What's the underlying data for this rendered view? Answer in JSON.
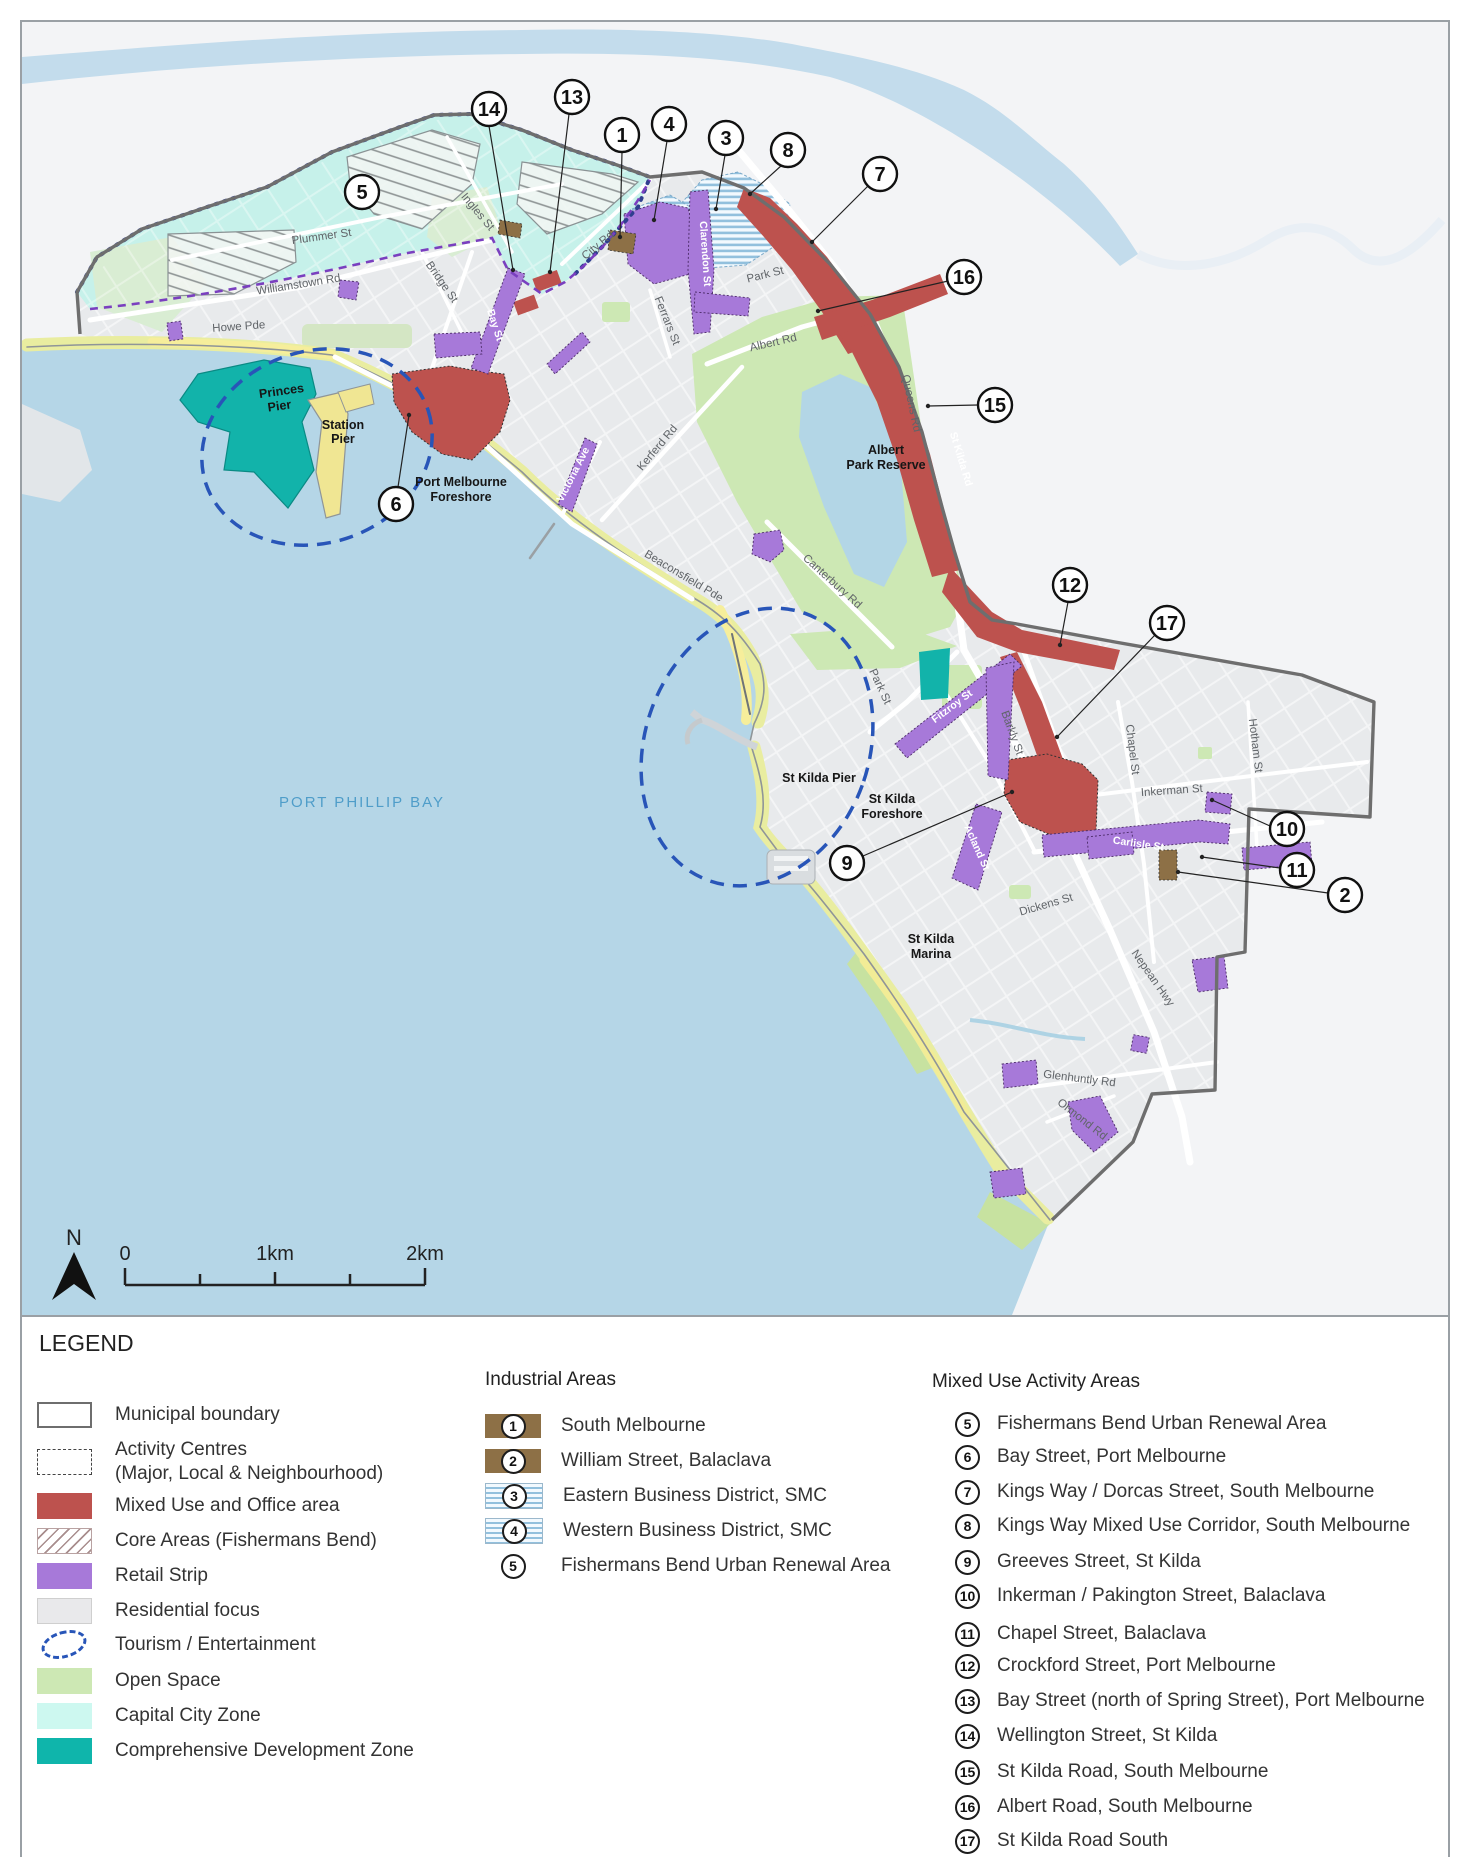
{
  "colors": {
    "water": "#b5d6e7",
    "land_outside": "#f3f4f6",
    "land_municipal": "#e8eaec",
    "open_space": "#cde8b4",
    "capital_city_zone": "#c6f1ea",
    "comprehensive_development": "#12b3aa",
    "mixed_use_office": "#bd524e",
    "retail_strip": "#a779d9",
    "industrial_brown": "#8d7046",
    "business_stripe_blue": "#92c0dd",
    "foreshore_yellow": "#e9eda0",
    "municipal_boundary": "#6e6e6e",
    "tourism_dash_blue": "#2855b8",
    "activity_dash_purple": "#7a3fbf",
    "bay_label_blue": "#4f9dc9"
  },
  "map": {
    "bay_label": "PORT PHILLIP BAY",
    "north_label": "N",
    "scale": {
      "zero": "0",
      "one": "1km",
      "two": "2km"
    },
    "labels": {
      "plummer_st": "Plummer St",
      "ingles_st": "Ingles St",
      "bridge_st": "Bridge St",
      "williamstown_rd": "Williamstown Rd",
      "howe_pde": "Howe Pde",
      "city_rd": "City Rd",
      "park_st_south_melbourne": "Park St",
      "ferrars_st": "Ferrars St",
      "albert_rd": "Albert Rd",
      "kerferd_rd": "Kerferd Rd",
      "queens_rd": "Queens Rd",
      "st_kilda_rd": "St Kilda Rd",
      "canterbury_rd": "Canterbury Rd",
      "beaconsfield_pde": "Beaconsfield Pde",
      "park_st_st_kilda": "Park St",
      "barkly_st": "Barkly St",
      "chapel_st": "Chapel St",
      "inkerman_st": "Inkerman St",
      "hotham_st": "Hotham St",
      "dickens_st": "Dickens St",
      "nepean_hwy": "Nepean Hwy",
      "glenhuntly_rd": "Glenhuntly Rd",
      "ormond_rd": "Ormond Rd",
      "bay_st": "Bay St",
      "clarendon_st": "Clarendon St",
      "victoria_ave": "Victoria Ave",
      "fitzroy_st": "Fitzroy St",
      "carlisle_st": "Carlisle St",
      "acland_st": "Acland St",
      "princes_pier": [
        "Princes",
        "Pier"
      ],
      "station_pier": [
        "Station",
        "Pier"
      ],
      "port_melbourne_foreshore": [
        "Port Melbourne",
        "Foreshore"
      ],
      "albert_park_reserve": [
        "Albert",
        "Park Reserve"
      ],
      "st_kilda_pier": "St Kilda Pier",
      "st_kilda_foreshore": [
        "St Kilda",
        "Foreshore"
      ],
      "st_kilda_marina": [
        "St Kilda",
        "Marina"
      ]
    },
    "callouts": {
      "c1": "1",
      "c2": "2",
      "c3": "3",
      "c4": "4",
      "c5": "5",
      "c6": "6",
      "c7": "7",
      "c8": "8",
      "c9": "9",
      "c10": "10",
      "c11": "11",
      "c12": "12",
      "c13": "13",
      "c14": "14",
      "c15": "15",
      "c16": "16",
      "c17": "17"
    }
  },
  "legend": {
    "title": "LEGEND",
    "items": [
      {
        "label": "Municipal boundary"
      },
      {
        "label": "Activity Centres",
        "label2": "(Major, Local & Neighbourhood)"
      },
      {
        "label": "Mixed Use and Office area"
      },
      {
        "label": "Core Areas (Fishermans Bend)"
      },
      {
        "label": "Retail Strip"
      },
      {
        "label": "Residential focus"
      },
      {
        "label": "Tourism / Entertainment"
      },
      {
        "label": "Open Space"
      },
      {
        "label": "Capital City Zone"
      },
      {
        "label": "Comprehensive Development Zone"
      }
    ],
    "industrial": {
      "title": "Industrial Areas",
      "items": [
        {
          "num": "1",
          "label": "South Melbourne"
        },
        {
          "num": "2",
          "label": "William Street, Balaclava"
        },
        {
          "num": "3",
          "label": "Eastern Business District, SMC"
        },
        {
          "num": "4",
          "label": "Western Business District, SMC"
        },
        {
          "num": "5",
          "label": "Fishermans Bend Urban  Renewal Area"
        }
      ]
    },
    "mixed": {
      "title": "Mixed Use Activity Areas",
      "items": [
        {
          "num": "5",
          "label": "Fishermans Bend Urban Renewal Area"
        },
        {
          "num": "6",
          "label": "Bay Street, Port Melbourne"
        },
        {
          "num": "7",
          "label": "Kings Way / Dorcas Street, South Melbourne"
        },
        {
          "num": "8",
          "label": "Kings Way Mixed Use Corridor, South Melbourne"
        },
        {
          "num": "9",
          "label": "Greeves Street, St Kilda"
        },
        {
          "num": "10",
          "label": "Inkerman / Pakington Street, Balaclava"
        },
        {
          "num": "11",
          "label": "Chapel Street, Balaclava"
        },
        {
          "num": "12",
          "label": "Crockford Street, Port Melbourne"
        },
        {
          "num": "13",
          "label": "Bay Street (north of Spring Street), Port Melbourne"
        },
        {
          "num": "14",
          "label": "Wellington Street, St Kilda"
        },
        {
          "num": "15",
          "label": "St Kilda Road, South Melbourne"
        },
        {
          "num": "16",
          "label": "Albert Road, South Melbourne"
        },
        {
          "num": "17",
          "label": "St Kilda Road South"
        }
      ]
    }
  }
}
